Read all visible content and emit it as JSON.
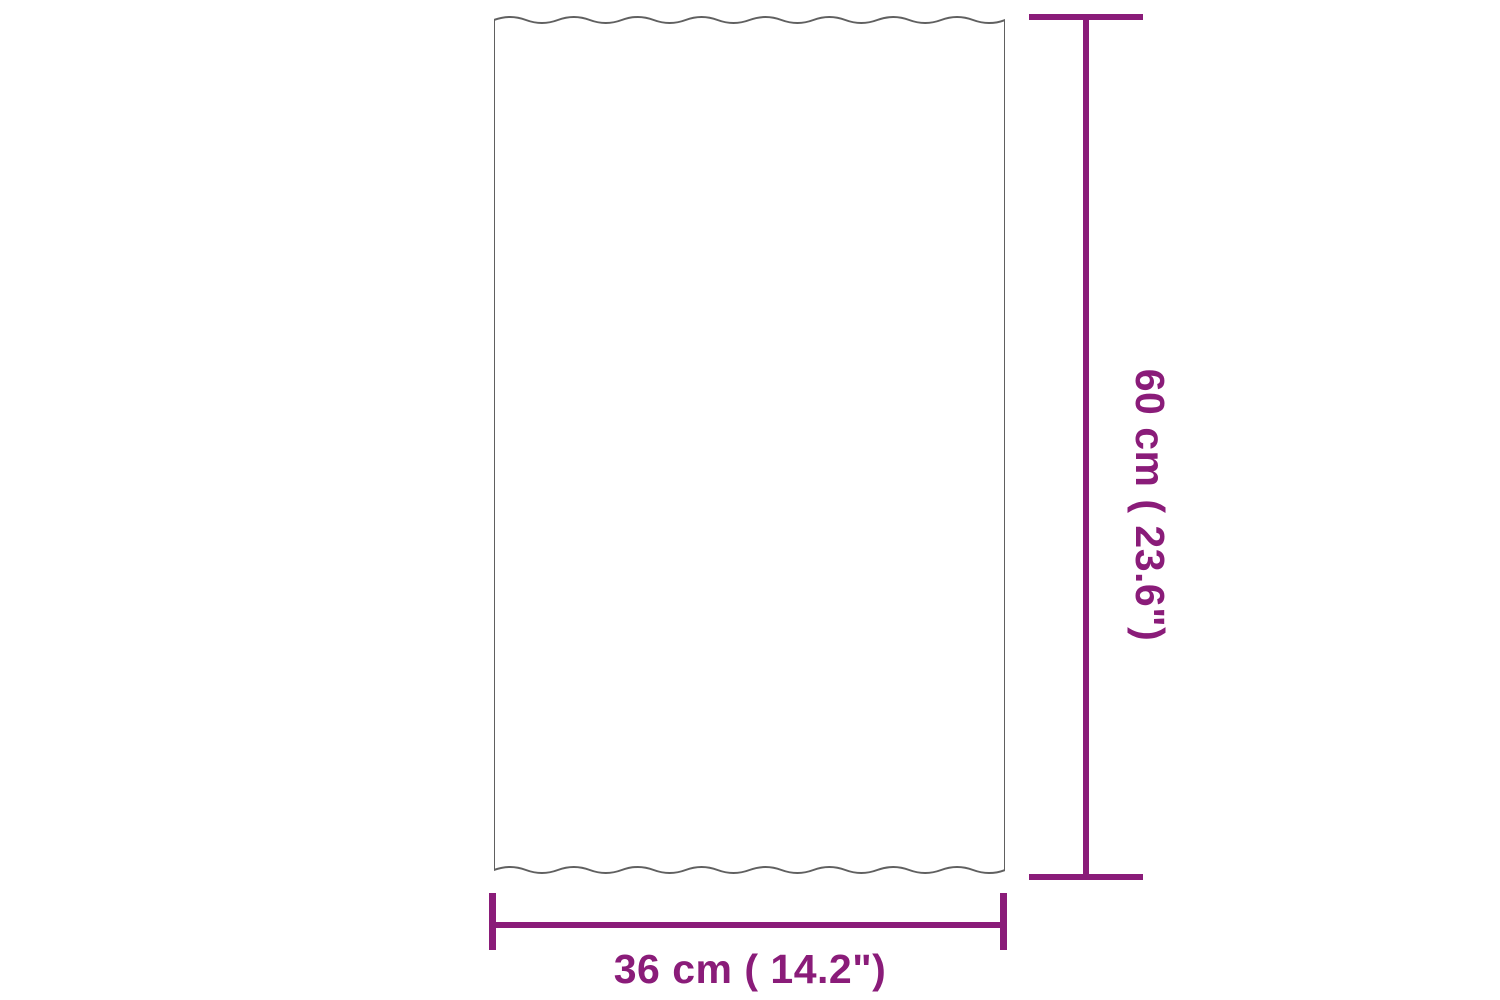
{
  "figure": {
    "type": "product-dimension-diagram",
    "object": "corrugated-roof-panel",
    "height_dimension": {
      "value_cm": 60,
      "value_inch": 23.6,
      "label": "60 cm ( 23.6\")"
    },
    "width_dimension": {
      "value_cm": 36,
      "value_inch": 14.2,
      "label": "36 cm ( 14.2\")"
    },
    "colors": {
      "dimension_accent": "#8A1C79",
      "panel_outline": "#606060",
      "background": "#FFFFFF"
    }
  }
}
